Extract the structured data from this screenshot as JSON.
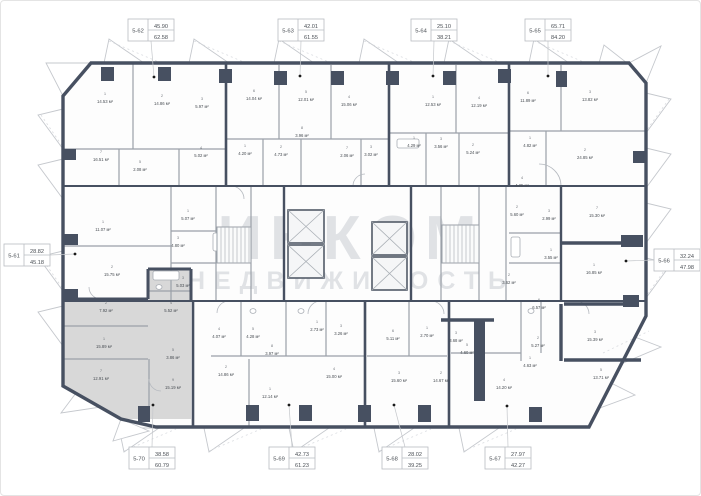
{
  "watermark": {
    "line1": "ИНКОМ",
    "line2": "НЕДВИЖИМОСТЬ"
  },
  "colors": {
    "wall": "#475061",
    "highlight": "#d8d8d8",
    "watermark": "#c9cdd3"
  },
  "apartments": [
    {
      "id": "5-62",
      "living": "45.90",
      "total": "62.58"
    },
    {
      "id": "5-63",
      "living": "42.01",
      "total": "61.55"
    },
    {
      "id": "5-64",
      "living": "25.10",
      "total": "38.21"
    },
    {
      "id": "5-65",
      "living": "65.71",
      "total": "84.20"
    },
    {
      "id": "5-61",
      "living": "28.82",
      "total": "45.18"
    },
    {
      "id": "5-66",
      "living": "32.24",
      "total": "47.98"
    },
    {
      "id": "5-70",
      "living": "38.58",
      "total": "60.79",
      "highlighted": true
    },
    {
      "id": "5-69",
      "living": "42.73",
      "total": "61.23"
    },
    {
      "id": "5-68",
      "living": "28.02",
      "total": "39.25"
    },
    {
      "id": "5-67",
      "living": "27.97",
      "total": "42.27"
    }
  ],
  "rooms": [
    {
      "n": "1",
      "a": "14.53 м²"
    },
    {
      "n": "2",
      "a": "14.86 м²"
    },
    {
      "n": "3",
      "a": "5.97 м²"
    },
    {
      "n": "7",
      "a": "16.51 м²"
    },
    {
      "n": "4",
      "a": "5.02 м²"
    },
    {
      "n": "5",
      "a": "2.08 м²"
    },
    {
      "n": "6",
      "a": "14.04 м²"
    },
    {
      "n": "5",
      "a": "12.01 м²"
    },
    {
      "n": "4",
      "a": "15.06 м²"
    },
    {
      "n": "8",
      "a": "3.96 м²"
    },
    {
      "n": "1",
      "a": "4.20 м²"
    },
    {
      "n": "2",
      "a": "4.73 м²"
    },
    {
      "n": "7",
      "a": "2.06 м²"
    },
    {
      "n": "3",
      "a": "3.02 м²"
    },
    {
      "n": "1",
      "a": "12.53 м²"
    },
    {
      "n": "4",
      "a": "12.19 м²"
    },
    {
      "n": "1",
      "a": "4.29 м²"
    },
    {
      "n": "3",
      "a": "3.56 м²"
    },
    {
      "n": "2",
      "a": "5.24 м²"
    },
    {
      "n": "6",
      "a": "11.89 м²"
    },
    {
      "n": "3",
      "a": "13.82 м²"
    },
    {
      "n": "1",
      "a": "4.82 м²"
    },
    {
      "n": "2",
      "a": "24.85 м²"
    },
    {
      "n": "4",
      "a": "4.25 м²"
    },
    {
      "n": "1",
      "a": "11.07 м²"
    },
    {
      "n": "2",
      "a": "15.75 м²"
    },
    {
      "n": "1",
      "a": "5.07 м²"
    },
    {
      "n": "3",
      "a": "4.80 м²"
    },
    {
      "n": "2",
      "a": "5.60 м²"
    },
    {
      "n": "3",
      "a": "2.99 м²"
    },
    {
      "n": "1",
      "a": "3.55 м²"
    },
    {
      "n": "2",
      "a": "3.62 м²"
    },
    {
      "n": "7",
      "a": "15.30 м²"
    },
    {
      "n": "1",
      "a": "16.85 м²"
    },
    {
      "n": "3",
      "a": "5.03 м²"
    },
    {
      "n": "2",
      "a": "7.92 м²"
    },
    {
      "n": "1",
      "a": "15.89 м²"
    },
    {
      "n": "4",
      "a": "5.52 м²"
    },
    {
      "n": "5",
      "a": "3.86 м²"
    },
    {
      "n": "7",
      "a": "12.91 м²"
    },
    {
      "n": "9",
      "a": "15.19 м²"
    },
    {
      "n": "4",
      "a": "4.07 м²"
    },
    {
      "n": "5",
      "a": "4.28 м²"
    },
    {
      "n": "8",
      "a": "3.97 м²"
    },
    {
      "n": "2",
      "a": "14.86 м²"
    },
    {
      "n": "1",
      "a": "12.14 м²"
    },
    {
      "n": "1",
      "a": "2.73 м²"
    },
    {
      "n": "3",
      "a": "3.26 м²"
    },
    {
      "n": "4",
      "a": "15.00 м²"
    },
    {
      "n": "6",
      "a": "5.11 м²"
    },
    {
      "n": "1",
      "a": "2.70 м²"
    },
    {
      "n": "3",
      "a": "15.60 м²"
    },
    {
      "n": "2",
      "a": "14.67 м²"
    },
    {
      "n": "3",
      "a": "3.68 м²"
    },
    {
      "n": "5",
      "a": "4.60 м²"
    },
    {
      "n": "6",
      "a": "6.57 м²"
    },
    {
      "n": "2",
      "a": "5.27 м²"
    },
    {
      "n": "1",
      "a": "4.63 м²"
    },
    {
      "n": "3",
      "a": "15.39 м²"
    },
    {
      "n": "5",
      "a": "13.71 м²"
    },
    {
      "n": "4",
      "a": "14.20 м²"
    }
  ]
}
